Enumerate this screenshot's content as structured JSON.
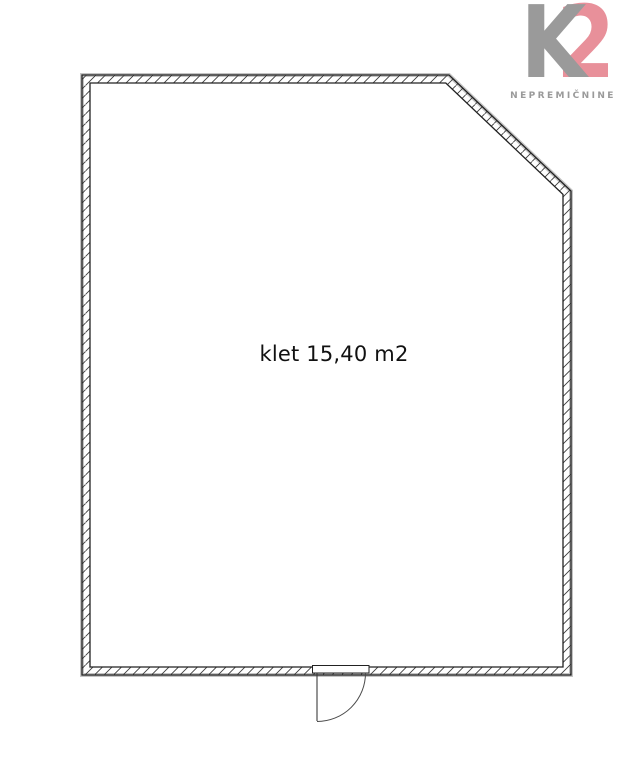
{
  "page": {
    "width": 624,
    "height": 768,
    "background_color": "#ffffff"
  },
  "logo": {
    "letter_k": "K",
    "letter_2": "2",
    "subtitle": "NEPREMIČNINE",
    "k_color": "#9a9a9a",
    "two_color": "#e8909a",
    "subtitle_color": "#9a9a9a"
  },
  "floorplan": {
    "room_label": "klet 15,40 m2",
    "room_name": "klet",
    "area_m2": "15,40",
    "line_color": "#222222",
    "hatch_color": "#3a3a3a",
    "shadow_color": "#c4c4c4",
    "wall_path": "M82,75 L449,75 L571,191 L571,675 L82,675 Z M90,83 L90,667 L563,667 L563,194.4 L445.8,83 Z",
    "wall_outer_path": "M82,75 L449,75 L571,191 L571,675 L82,675 Z",
    "door": {
      "frame_path": "M312.5,665.5 h56.5 v7.5 h-56.5 Z",
      "leaf_path": "M317,673 L317,721",
      "swing_path": "M365.5,673 A48.5,48.5 0 0 1 317,721.5"
    }
  }
}
